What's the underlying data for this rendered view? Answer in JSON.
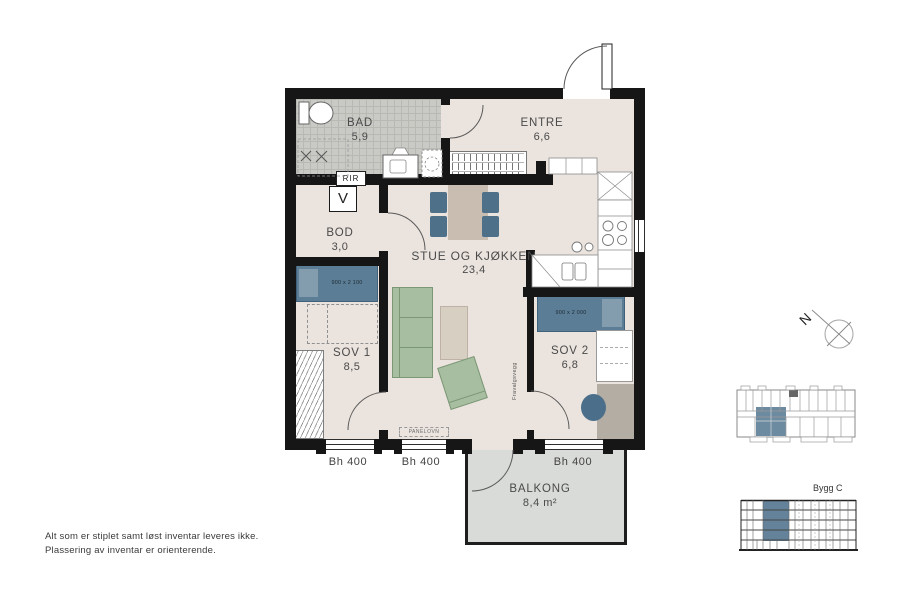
{
  "rooms": {
    "bad": {
      "name": "BAD",
      "area": "5,9"
    },
    "entre": {
      "name": "ENTRE",
      "area": "6,6"
    },
    "bod": {
      "name": "BOD",
      "area": "3,0"
    },
    "stue_kjokken": {
      "name": "STUE OG KJØKKEN",
      "area": "23,4"
    },
    "sov1": {
      "name": "SOV 1",
      "area": "8,5"
    },
    "sov2": {
      "name": "SOV 2",
      "area": "6,8"
    },
    "balkong": {
      "name": "BALKONG",
      "area": "8,4 m²"
    }
  },
  "annotations": {
    "rir": "RIR",
    "ventilation": "V",
    "panel_heater": "PANELOVN",
    "optional_wall": "Fravalgsvegg",
    "window_sill_height": "Bh 400",
    "bed_sov1_size": "900 x 2 100",
    "bed_sov2_size": "900 x 2 000"
  },
  "compass": {
    "north_label": "N"
  },
  "key_plan": {
    "building_label": "Bygg C"
  },
  "footnote": {
    "line1": "Alt som er stiplet samt løst inventar leveres ikke.",
    "line2": "Plassering av inventar er orienterende."
  },
  "colors": {
    "wall": "#161616",
    "floor": "#ebe3dd",
    "bath_floor": "#c9c9c5",
    "balcony_floor": "#d9dbd8",
    "furniture_blue": "#5b7d95",
    "furniture_green": "#a8bea0",
    "unit_highlight": "#64839a"
  }
}
